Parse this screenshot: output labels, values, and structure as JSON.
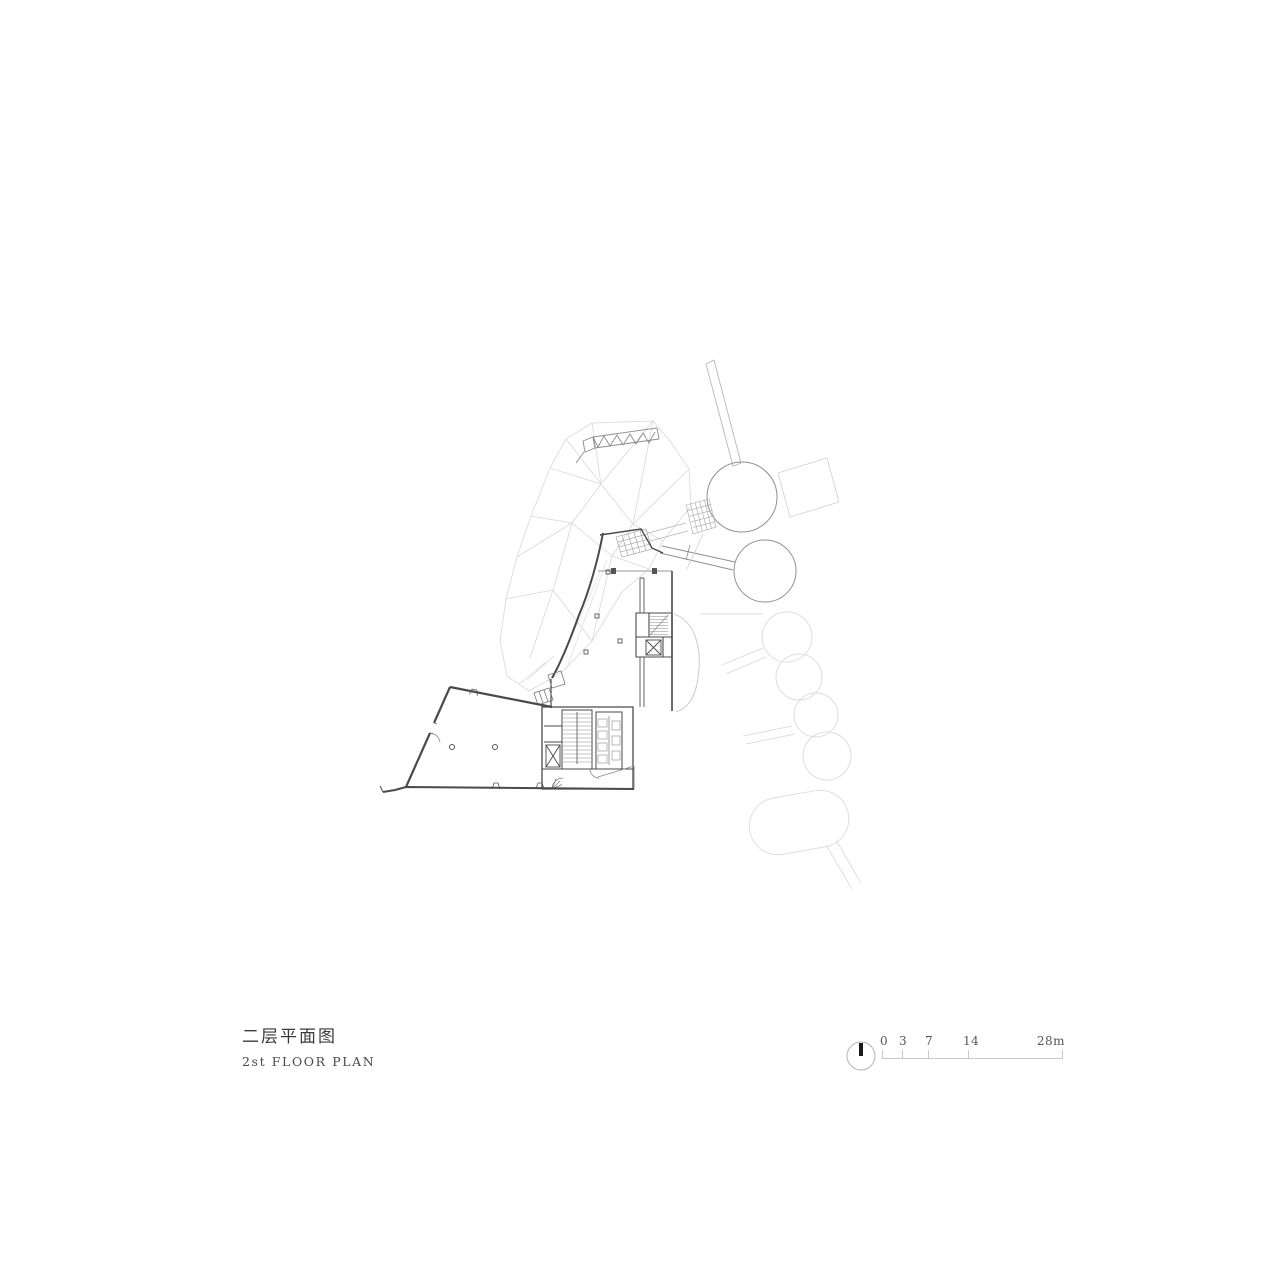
{
  "title_block": {
    "title_cn": "二层平面图",
    "title_en": "2st FLOOR PLAN"
  },
  "scale_bar": {
    "unit_total": "28m",
    "labels": [
      "0",
      "3",
      "7",
      "14",
      "28m"
    ]
  },
  "drawing": {
    "subject": "second floor architectural plan",
    "elements": [
      "faceted-canopy-outline",
      "roof-truss-band",
      "tree-pod-upper",
      "tree-pod-lower",
      "access-bridge",
      "tree-pod-chain",
      "main-hall",
      "stair-core",
      "elevator-shaft",
      "restroom-block",
      "angled-west-wing"
    ],
    "colors": {
      "background": "#ffffff",
      "wall_dark": "#4a4a4a",
      "line_mid": "#8f8f8f",
      "line_faint": "#d8d8d8",
      "needle_black": "#1a1a1a"
    }
  },
  "icons": {
    "compass": "north-arrow-icon"
  }
}
